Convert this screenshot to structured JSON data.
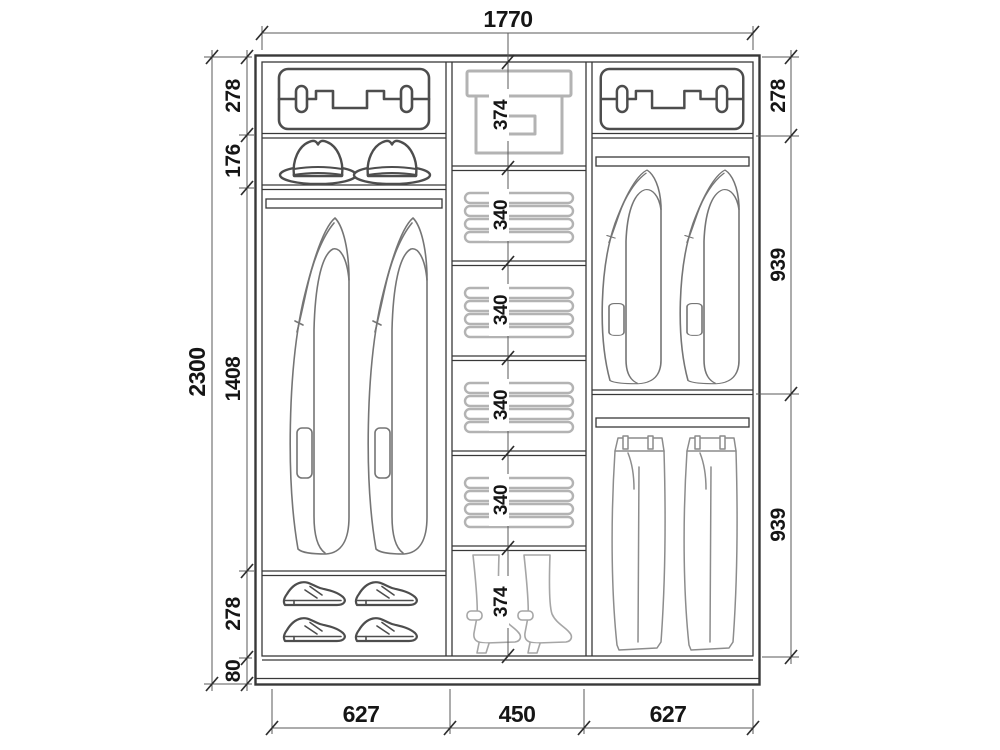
{
  "overall": {
    "width": "1770",
    "height": "2300"
  },
  "columns": {
    "left": {
      "width": "627",
      "sections": [
        {
          "name": "suitcase shelf",
          "height": "278"
        },
        {
          "name": "hat shelf",
          "height": "176"
        },
        {
          "name": "hanging rail section",
          "height": "1408"
        },
        {
          "name": "shoe shelf",
          "height": "278"
        },
        {
          "name": "plinth",
          "height": "80"
        }
      ]
    },
    "middle": {
      "width": "450",
      "sections": [
        {
          "name": "storage box shelf",
          "height": "374"
        },
        {
          "name": "folded clothes shelf",
          "height": "340"
        },
        {
          "name": "folded clothes shelf",
          "height": "340"
        },
        {
          "name": "folded clothes shelf",
          "height": "340"
        },
        {
          "name": "folded clothes shelf",
          "height": "340"
        },
        {
          "name": "boot shelf",
          "height": "374"
        }
      ]
    },
    "right": {
      "width": "627",
      "sections": [
        {
          "name": "suitcase shelf",
          "height": "278"
        },
        {
          "name": "jacket hanging section",
          "height": "939"
        },
        {
          "name": "trouser hanging section",
          "height": "939"
        }
      ]
    }
  },
  "icons": [
    "suitcase-icon",
    "hat-icon",
    "jacket-icon",
    "folded-clothes-icon",
    "storage-box-icon",
    "boot-icon",
    "shoe-icon",
    "trousers-icon",
    "hanging-rod"
  ],
  "colors": {
    "frame": "#383838",
    "dimension": "#5a5a5a",
    "light_items": "#b3b3b3",
    "medium_items": "#8c8c8c",
    "text": "#151515",
    "background": "#ffffff"
  }
}
